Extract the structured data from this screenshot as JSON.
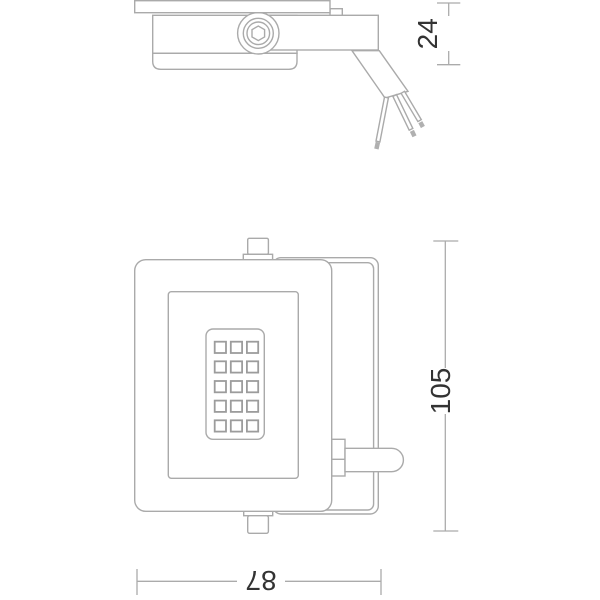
{
  "drawing": {
    "type": "technical-line-drawing",
    "views": {
      "side_profile": {
        "wires": 3
      },
      "front": {
        "led_rows": 5,
        "led_cols": 3
      }
    },
    "dimensions": {
      "depth": {
        "value": "24",
        "orientation": "vertical"
      },
      "height": {
        "value": "105",
        "orientation": "vertical"
      },
      "width": {
        "value": "87",
        "orientation": "horizontal-rotated-180"
      }
    },
    "colors": {
      "line": "#aaaaaa",
      "dimension_text": "#333333",
      "background": "#ffffff"
    }
  }
}
